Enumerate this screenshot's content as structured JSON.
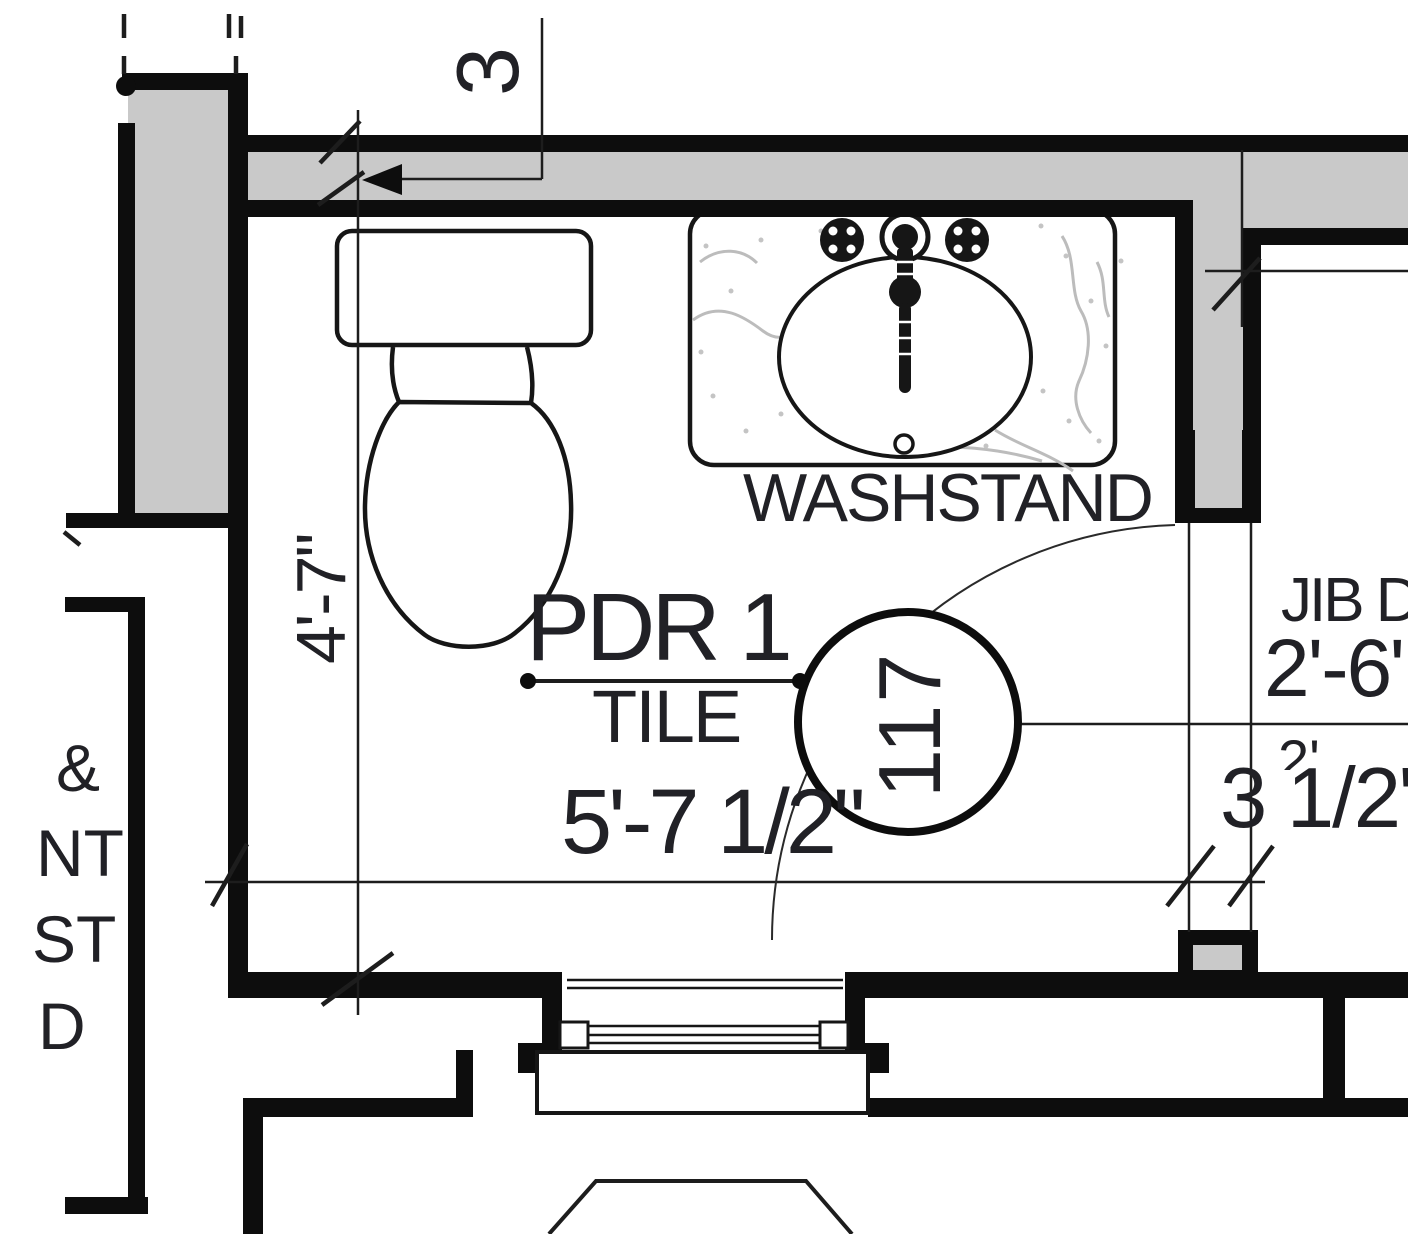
{
  "room": {
    "name": "PDR 1",
    "finish": "TILE",
    "number": "117"
  },
  "labels": {
    "washstand": "WASHSTAND"
  },
  "dimensions": {
    "room_width": "5'-7 1/2\"",
    "room_depth": "4'-7\"",
    "top_wall_offset": "3",
    "jamb_width": "3 1/2\"",
    "jib_door_name": "JIB DOOR",
    "jib_door_width": "2'-6\""
  },
  "fragments": {
    "overlap": "2'",
    "left_edge": [
      "&",
      "NT",
      "ST",
      "D"
    ]
  },
  "colors": {
    "wall_poche": "#c9c9c9",
    "line": "#161616",
    "marble_vein": "#bcbcbc"
  }
}
